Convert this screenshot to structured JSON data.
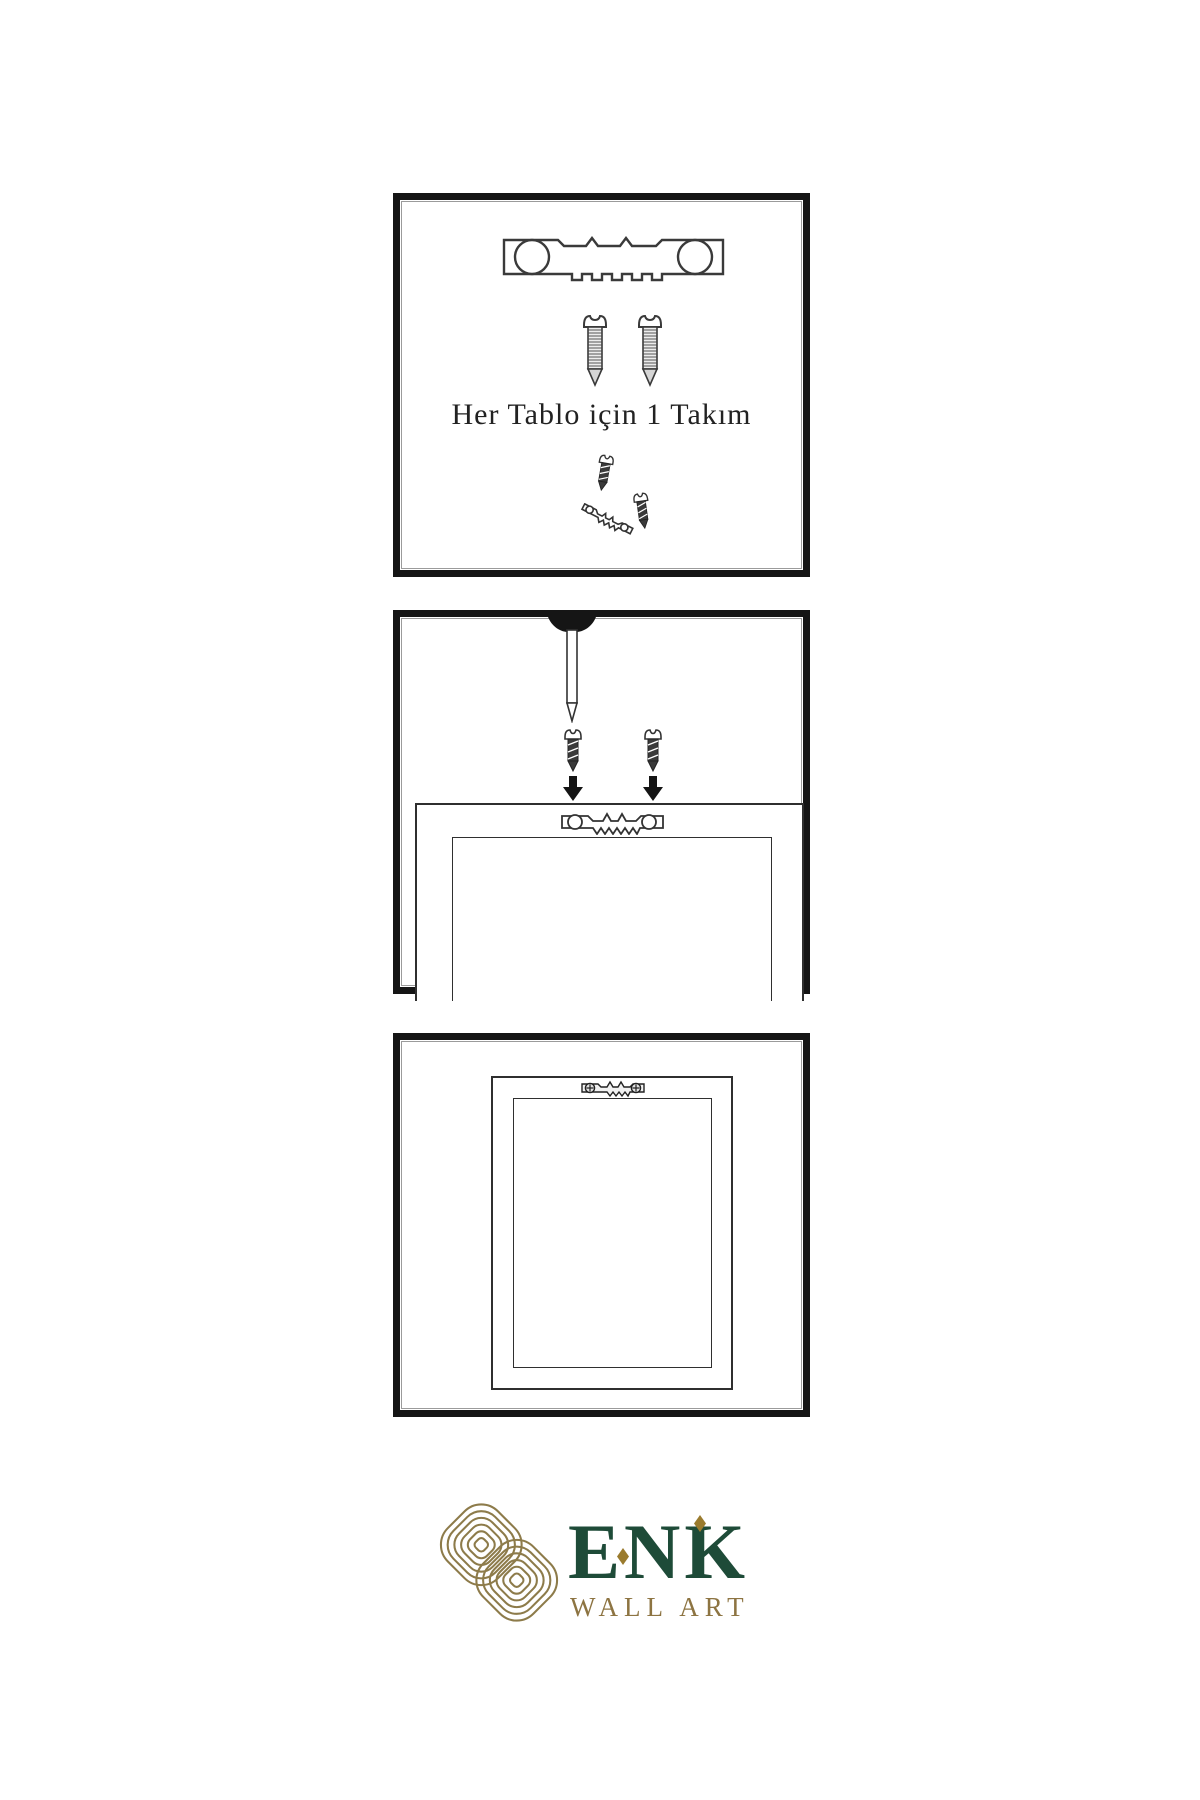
{
  "page": {
    "background": "#ffffff"
  },
  "panels": [
    {
      "id": "hardware-kit",
      "caption": "Her Tablo için 1 Takım",
      "items": [
        "sawtooth-hanger",
        "screw",
        "screw",
        "screw-with-angled-hanger"
      ]
    },
    {
      "id": "installation-step",
      "items": [
        "wall-nail",
        "screw",
        "screw",
        "down-arrow",
        "down-arrow",
        "frame-back-with-sawtooth-hanger"
      ]
    },
    {
      "id": "hung-frame",
      "items": [
        "frame-front-with-mounted-hanger"
      ]
    }
  ],
  "logo": {
    "brand": "ENK",
    "subtitle": "WALL ART",
    "knot_icon": "knot-logo",
    "brand_color": "#1e4b38",
    "gold_color": "#8d7442"
  },
  "colors": {
    "line": "#333333",
    "panel_border": "#151515",
    "brand_green": "#1e4b38",
    "logo_gold": "#8d7b4a",
    "accent_diamond": "#9a7b2e",
    "text": "#222222"
  }
}
